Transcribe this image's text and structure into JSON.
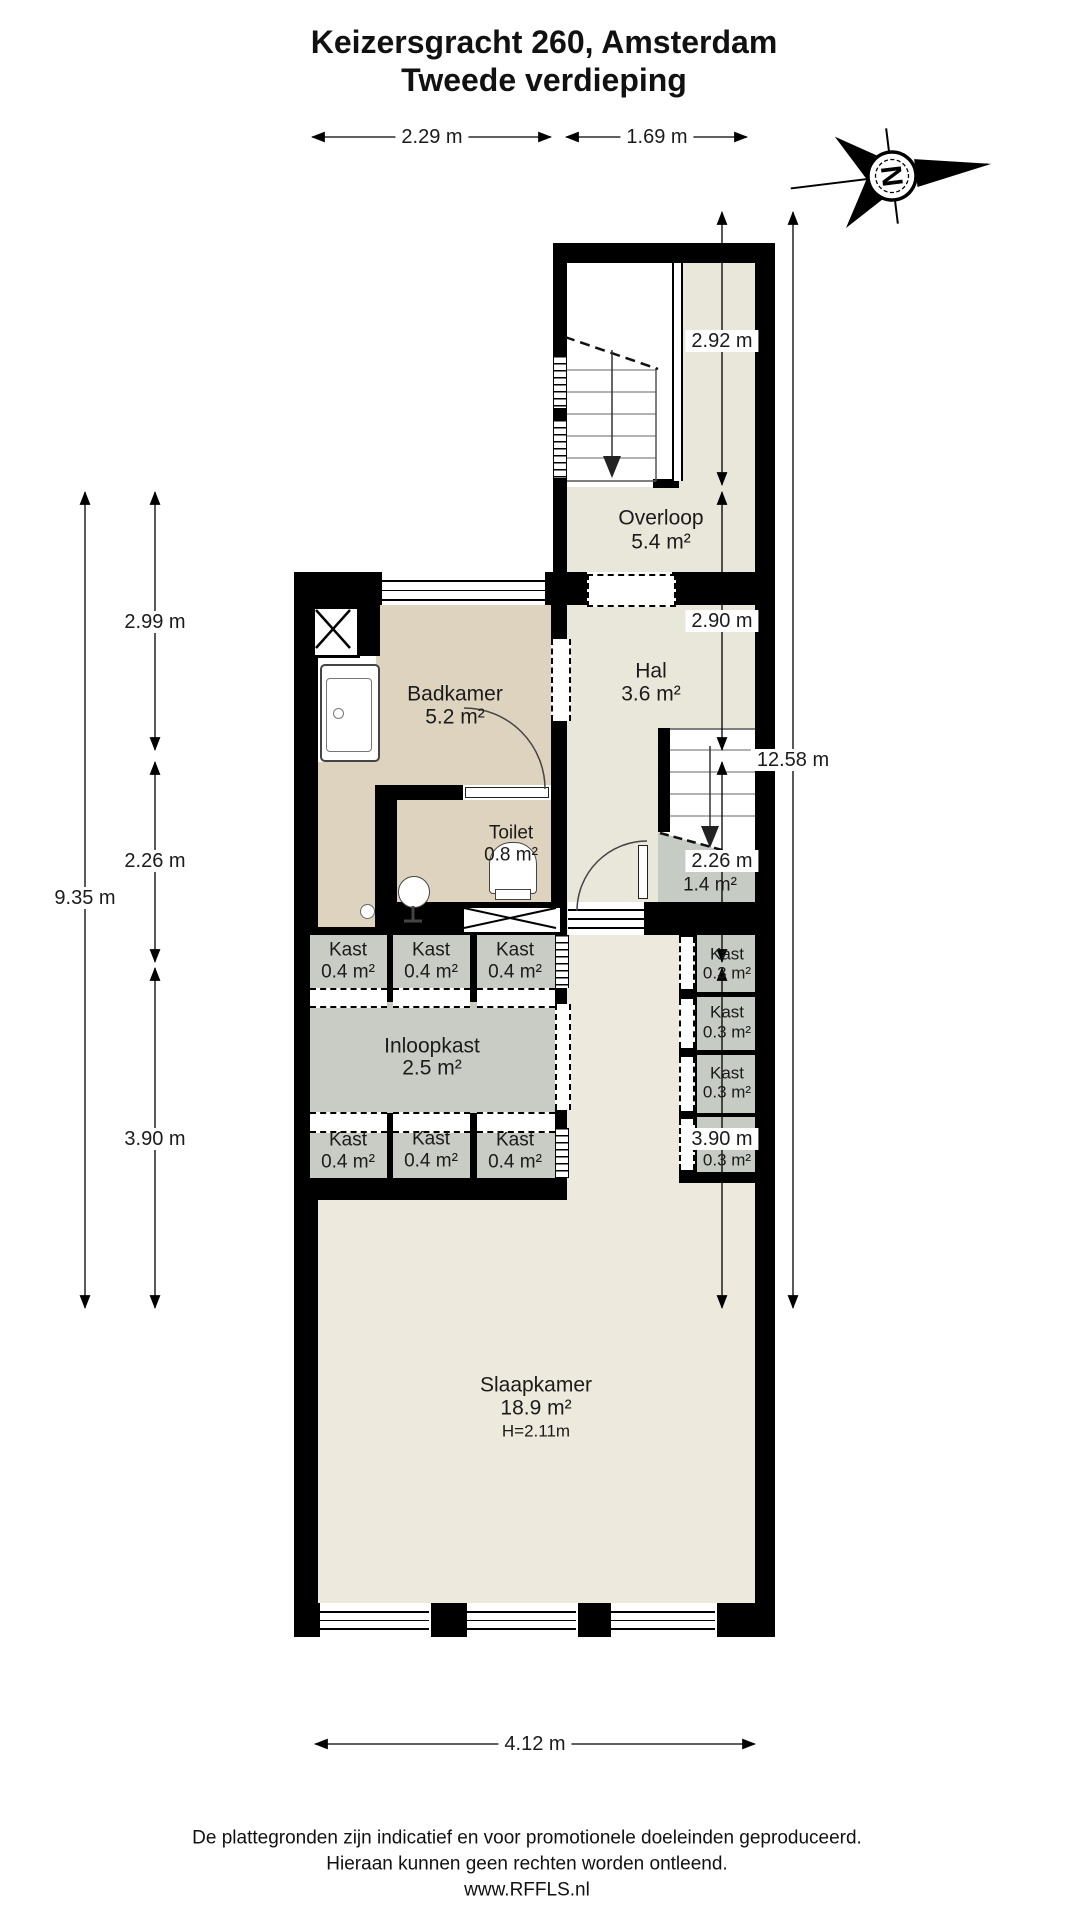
{
  "title": {
    "line1": "Keizersgracht 260, Amsterdam",
    "line2": "Tweede verdieping"
  },
  "compass": {
    "north_letter": "N"
  },
  "rooms": {
    "overloop": {
      "name": "Overloop",
      "area": "5.4 m²"
    },
    "hal": {
      "name": "Hal",
      "area": "3.6 m²"
    },
    "badkamer": {
      "name": "Badkamer",
      "area": "5.2 m²"
    },
    "toilet": {
      "name": "Toilet",
      "area": "0.8 m²"
    },
    "kast_hal": {
      "name": "Kast",
      "area": "1.4 m²"
    },
    "inloopkast": {
      "name": "Inloopkast",
      "area": "2.5 m²"
    },
    "kast_04": {
      "name": "Kast",
      "area": "0.4 m²"
    },
    "kast_03": {
      "name": "Kast",
      "area": "0.3 m²"
    },
    "slaapkamer": {
      "name": "Slaapkamer",
      "area": "18.9 m²",
      "ceiling_height": "H=2.11m"
    }
  },
  "dimensions": {
    "top_left": "2.29 m",
    "top_right": "1.69 m",
    "bottom": "4.12 m",
    "left_total": "9.35 m",
    "left_upper": "2.99 m",
    "left_middle": "2.26 m",
    "left_lower": "3.90 m",
    "right_total": "12.58 m",
    "right_top": "2.92 m",
    "right_upper": "2.90 m",
    "right_middle": "2.26 m",
    "right_lower": "3.90 m"
  },
  "footer": {
    "line1": "De plattegronden zijn indicatief en voor promotionele doeleinden geproduceerd.",
    "line2": "Hieraan kunnen geen rechten worden ontleend.",
    "line3": "www.RFFLS.nl"
  },
  "colors": {
    "wall": "#000000",
    "floor_hall": "#e9e6da",
    "floor_bedroom": "#edeadd",
    "floor_bath": "#ded3bf",
    "closet": "#c8ccc4"
  }
}
